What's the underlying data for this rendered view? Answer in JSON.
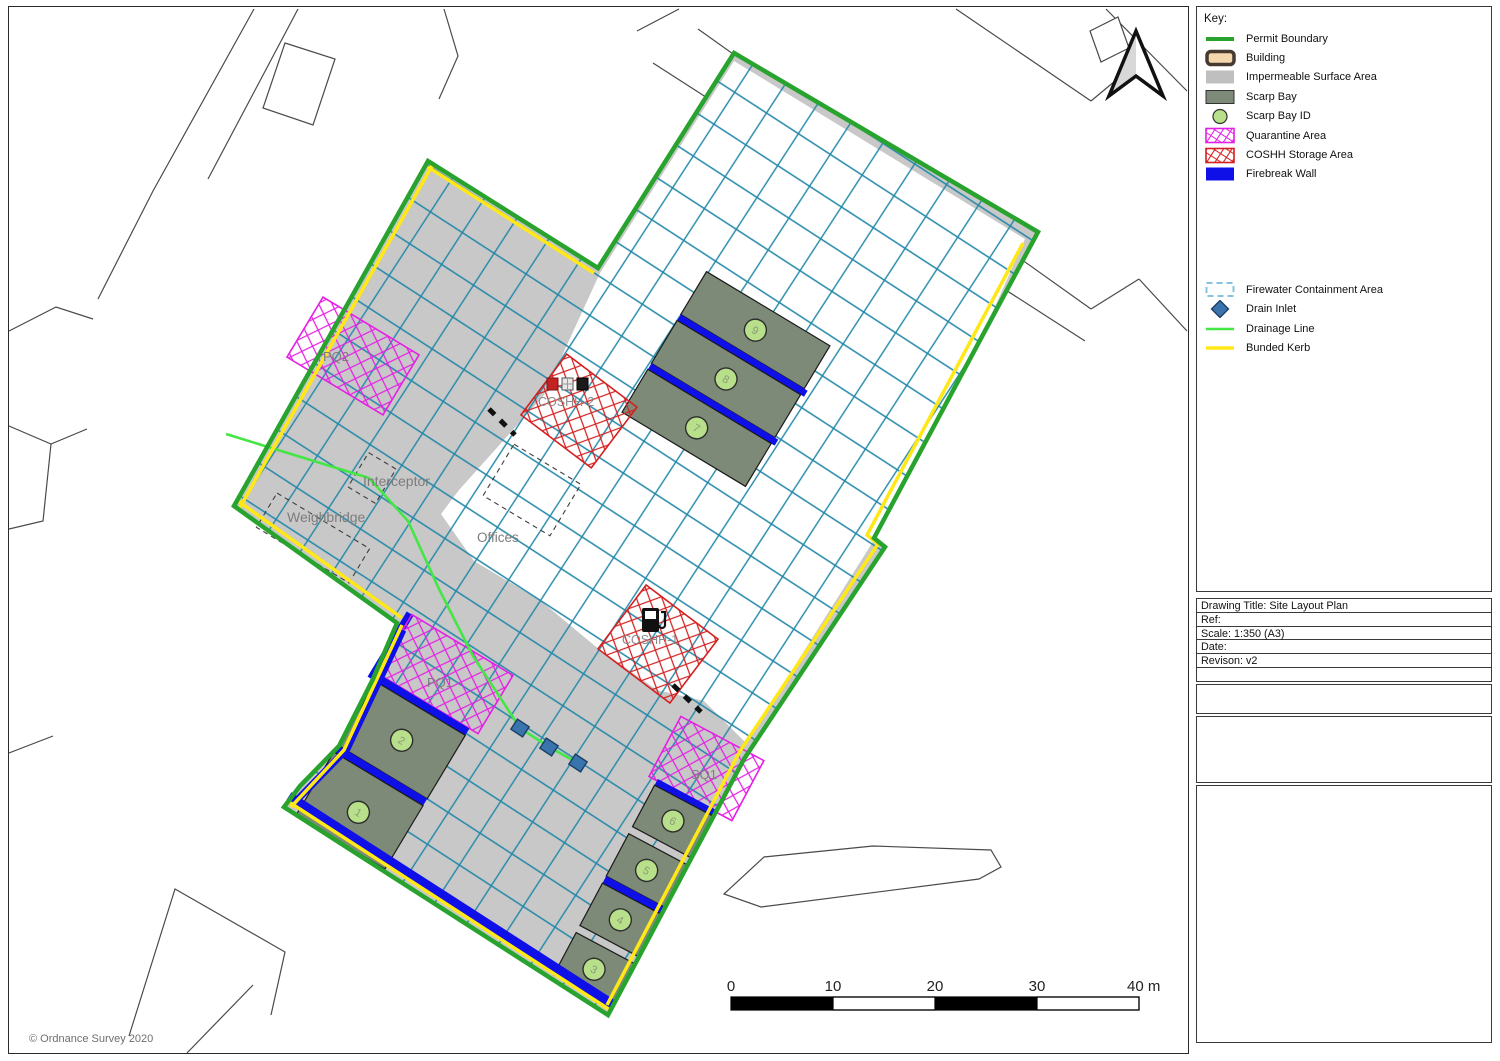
{
  "legend": {
    "title": "Key:",
    "group1": [
      "Permit Boundary",
      "Building",
      "Impermeable Surface Area",
      "Scarp Bay",
      "Scarp Bay ID",
      "Quarantine Area",
      "COSHH Storage Area",
      "Firebreak Wall"
    ],
    "group2": [
      "Firewater Containment Area",
      "Drain Inlet",
      "Drainage Line",
      "Bunded Kerb"
    ]
  },
  "title_block": {
    "drawing_title": "Drawing Title: Site Layout Plan",
    "ref": "Ref:",
    "scale": "Scale: 1:350 (A3)",
    "date": "Date:",
    "revision": "Revison: v2"
  },
  "map": {
    "labels": {
      "pq2": "PQ2",
      "interceptor": "Interceptor",
      "weighbridge": "Weighbridge",
      "offices": "Offices",
      "coshh2": "COSHH-2",
      "coshh1": "COSHH-1",
      "pq1": "PQ1",
      "sq1": "SQ1"
    },
    "bay_ids": {
      "b1": "1",
      "b2": "2",
      "b3": "3",
      "b4": "4",
      "b5": "5",
      "b6": "6",
      "b7": "7",
      "b8": "8",
      "b9": "9"
    },
    "copyright": "© Ordnance Survey 2020"
  },
  "scalebar": {
    "t0": "0",
    "t10": "10",
    "t20": "20",
    "t30": "30",
    "t40": "40 m"
  },
  "colors": {
    "permit_boundary": "#27a32e",
    "bunded_kerb": "#ffe816",
    "firebreak_wall": "#0f0fe8",
    "drainage_line": "#44e644",
    "quarantine": "#e520e5",
    "coshh": "#d42020",
    "containment_grid": "#2187a8",
    "impermeable_surface": "#c8c8c8",
    "scarp_bay": "#7d8a77",
    "scarp_bay_id": "#b8e08a",
    "drain_inlet": "#3a74ad",
    "building_fill": "#f5d7ae"
  }
}
